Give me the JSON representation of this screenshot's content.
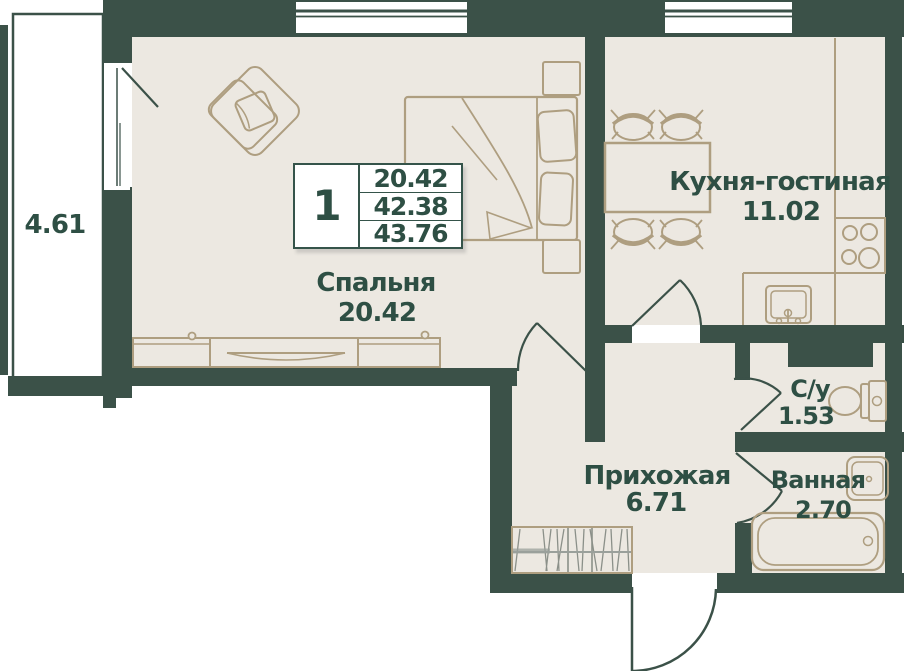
{
  "plan": {
    "title": "apartment floor plan",
    "balcony": {
      "area": "4.61"
    },
    "rooms": [
      {
        "id": "bedroom",
        "name": "Спальня",
        "area": "20.42"
      },
      {
        "id": "kitchen",
        "name": "Кухня-гостиная",
        "area": "11.02"
      },
      {
        "id": "hallway",
        "name": "Прихожая",
        "area": "6.71"
      },
      {
        "id": "wc",
        "name": "С/у",
        "area": "1.53"
      },
      {
        "id": "bathroom",
        "name": "Ванная",
        "area": "2.70"
      }
    ],
    "info_table": {
      "rooms_count": "1",
      "values": [
        "20.42",
        "42.38",
        "43.76"
      ]
    },
    "colors": {
      "wall": "#3B5148",
      "floor": "#ECE8E1",
      "furniture": "#AE9E80",
      "label": "#2E4F44",
      "hatch": "#8B9089"
    }
  }
}
